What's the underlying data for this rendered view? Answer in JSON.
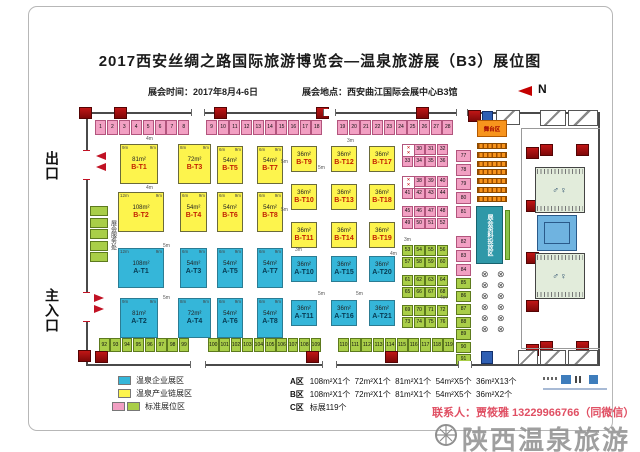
{
  "title": "2017西安丝绸之路国际旅游博览会—温泉旅游展（B3）展位图",
  "subtitle": {
    "time": "展会时间：2017年8月4-6日",
    "venue": "展会地点：西安曲江国际会展中心B3馆"
  },
  "north_label": "N",
  "labels": {
    "exit": "出口",
    "main_entrance": "主入口",
    "service_desk": "展会服务处",
    "stage": "舞台区",
    "info_strip": "展会资料投放区"
  },
  "icons": {
    "restroom": "♂♀",
    "table": "⊗",
    "no_booth": "✕\n✕"
  },
  "colors": {
    "booth_blue": "#35b6d9",
    "booth_yellow": "#fdf44d",
    "standard_pink": "#f2a0c3",
    "standard_green": "#a9ce48",
    "pillar_red": "#b01212",
    "stage_orange": "#f7941d",
    "info_teal": "#2f98a8",
    "accent_red": "#c11224",
    "contact_red": "#e04f63"
  },
  "legend": {
    "items": [
      {
        "swatches": [
          "blue"
        ],
        "label": "温泉企业展区"
      },
      {
        "swatches": [
          "yellow"
        ],
        "label": "温泉产业链展区"
      },
      {
        "swatches": [
          "pink",
          "green"
        ],
        "label": "标准展位区"
      }
    ],
    "stats": [
      {
        "zone": "A区",
        "detail": "108m²X1个  72m²X1个  81m²X1个  54m²X5个  36m²X13个"
      },
      {
        "zone": "B区",
        "detail": "108m²X1个  72m²X1个  81m²X1个  54m²X5个  36m²X2个"
      },
      {
        "zone": "C区",
        "detail": "标展119个"
      }
    ]
  },
  "contact": "联系人：贾筱雅 13229966766（同微信）",
  "watermark": "陕西温泉旅游",
  "plan": {
    "booths": [
      {
        "name": "B-T1",
        "area": "81m²",
        "x": 120,
        "y": 144,
        "w": 38,
        "h": 40,
        "wm": "9m",
        "dm": "9m"
      },
      {
        "name": "B-T3",
        "area": "72m²",
        "x": 178,
        "y": 144,
        "w": 33,
        "h": 40,
        "wm": "8m",
        "dm": "9m"
      },
      {
        "name": "B-T5",
        "area": "54m²",
        "x": 217,
        "y": 146,
        "w": 26,
        "h": 38,
        "wm": "6m",
        "dm": "9m"
      },
      {
        "name": "B-T7",
        "area": "54m²",
        "x": 257,
        "y": 146,
        "w": 26,
        "h": 38,
        "wm": "6m",
        "dm": "9m"
      },
      {
        "name": "B-T2",
        "area": "108m²",
        "x": 118,
        "y": 192,
        "w": 46,
        "h": 40,
        "wm": "12m",
        "dm": "9m"
      },
      {
        "name": "B-T4",
        "area": "54m²",
        "x": 180,
        "y": 192,
        "w": 27,
        "h": 40,
        "wm": "6m",
        "dm": "9m"
      },
      {
        "name": "B-T6",
        "area": "54m²",
        "x": 217,
        "y": 192,
        "w": 26,
        "h": 40,
        "wm": "6m",
        "dm": "9m"
      },
      {
        "name": "B-T8",
        "area": "54m²",
        "x": 257,
        "y": 192,
        "w": 26,
        "h": 40,
        "wm": "6m",
        "dm": "9m"
      },
      {
        "name": "B-T9",
        "area": "36m²",
        "x": 291,
        "y": 146,
        "w": 26,
        "h": 26
      },
      {
        "name": "B-T10",
        "area": "36m²",
        "x": 291,
        "y": 184,
        "w": 26,
        "h": 26
      },
      {
        "name": "B-T11",
        "area": "36m²",
        "x": 291,
        "y": 222,
        "w": 26,
        "h": 26
      },
      {
        "name": "B-T12",
        "area": "36m²",
        "x": 331,
        "y": 146,
        "w": 26,
        "h": 26
      },
      {
        "name": "B-T13",
        "area": "36m²",
        "x": 331,
        "y": 184,
        "w": 26,
        "h": 26
      },
      {
        "name": "B-T14",
        "area": "36m²",
        "x": 331,
        "y": 222,
        "w": 26,
        "h": 26
      },
      {
        "name": "B-T17",
        "area": "36m²",
        "x": 369,
        "y": 146,
        "w": 26,
        "h": 26
      },
      {
        "name": "B-T18",
        "area": "36m²",
        "x": 369,
        "y": 184,
        "w": 26,
        "h": 26
      },
      {
        "name": "B-T19",
        "area": "36m²",
        "x": 369,
        "y": 222,
        "w": 26,
        "h": 26
      },
      {
        "name": "A-T1",
        "area": "108m²",
        "x": 118,
        "y": 248,
        "w": 46,
        "h": 40,
        "wm": "12m",
        "dm": "9m"
      },
      {
        "name": "A-T3",
        "area": "54m²",
        "x": 180,
        "y": 248,
        "w": 27,
        "h": 40,
        "wm": "6m",
        "dm": "9m"
      },
      {
        "name": "A-T5",
        "area": "54m²",
        "x": 217,
        "y": 248,
        "w": 26,
        "h": 40,
        "wm": "6m",
        "dm": "9m"
      },
      {
        "name": "A-T7",
        "area": "54m²",
        "x": 257,
        "y": 248,
        "w": 26,
        "h": 40,
        "wm": "6m",
        "dm": "9m"
      },
      {
        "name": "A-T2",
        "area": "81m²",
        "x": 120,
        "y": 298,
        "w": 38,
        "h": 40,
        "wm": "9m",
        "dm": "9m"
      },
      {
        "name": "A-T4",
        "area": "72m²",
        "x": 178,
        "y": 298,
        "w": 33,
        "h": 40,
        "wm": "8m",
        "dm": "9m"
      },
      {
        "name": "A-T6",
        "area": "54m²",
        "x": 217,
        "y": 298,
        "w": 26,
        "h": 40,
        "wm": "6m",
        "dm": "9m"
      },
      {
        "name": "A-T8",
        "area": "54m²",
        "x": 257,
        "y": 298,
        "w": 26,
        "h": 40,
        "wm": "6m",
        "dm": "9m"
      },
      {
        "name": "A-T10",
        "area": "36m²",
        "x": 291,
        "y": 256,
        "w": 26,
        "h": 26
      },
      {
        "name": "A-T11",
        "area": "36m²",
        "x": 291,
        "y": 300,
        "w": 26,
        "h": 26
      },
      {
        "name": "A-T15",
        "area": "36m²",
        "x": 331,
        "y": 256,
        "w": 26,
        "h": 26
      },
      {
        "name": "A-T16",
        "area": "36m²",
        "x": 331,
        "y": 300,
        "w": 26,
        "h": 26
      },
      {
        "name": "A-T20",
        "area": "36m²",
        "x": 369,
        "y": 256,
        "w": 26,
        "h": 26
      },
      {
        "name": "A-T21",
        "area": "36m²",
        "x": 369,
        "y": 300,
        "w": 26,
        "h": 26
      }
    ],
    "standard_groups": [
      {
        "start": 1,
        "end": 8,
        "x": 95,
        "y": 120,
        "pitch": 11.9,
        "w": 11,
        "h": 15,
        "color": "pink",
        "dir": "h"
      },
      {
        "start": 9,
        "end": 18,
        "x": 206,
        "y": 120,
        "pitch": 11.7,
        "w": 11,
        "h": 15,
        "color": "pink",
        "dir": "h"
      },
      {
        "start": 19,
        "end": 28,
        "x": 337,
        "y": 120,
        "pitch": 11.7,
        "w": 11,
        "h": 15,
        "color": "pink",
        "dir": "h"
      },
      {
        "start": 30,
        "end": 32,
        "x": 413.7,
        "y": 144,
        "pitch": 11.7,
        "w": 11,
        "h": 11,
        "color": "pink",
        "dir": "h"
      },
      {
        "start": 33,
        "end": 36,
        "x": 402,
        "y": 155.5,
        "pitch": 11.7,
        "w": 11,
        "h": 11,
        "color": "pink",
        "dir": "h"
      },
      {
        "start": 38,
        "end": 40,
        "x": 413.7,
        "y": 176,
        "pitch": 11.7,
        "w": 11,
        "h": 11,
        "color": "pink",
        "dir": "h"
      },
      {
        "start": 41,
        "end": 44,
        "x": 402,
        "y": 187.5,
        "pitch": 11.7,
        "w": 11,
        "h": 11,
        "color": "pink",
        "dir": "h"
      },
      {
        "start": 45,
        "end": 48,
        "x": 402,
        "y": 206,
        "pitch": 11.7,
        "w": 11,
        "h": 11,
        "color": "pink",
        "dir": "h"
      },
      {
        "start": 49,
        "end": 52,
        "x": 402,
        "y": 217.5,
        "pitch": 11.7,
        "w": 11,
        "h": 11,
        "color": "pink",
        "dir": "h"
      },
      {
        "start": 53,
        "end": 56,
        "x": 402,
        "y": 245,
        "pitch": 11.7,
        "w": 11,
        "h": 11,
        "color": "green",
        "dir": "h"
      },
      {
        "start": 57,
        "end": 60,
        "x": 402,
        "y": 256.5,
        "pitch": 11.7,
        "w": 11,
        "h": 11,
        "color": "green",
        "dir": "h"
      },
      {
        "start": 61,
        "end": 64,
        "x": 402,
        "y": 275,
        "pitch": 11.7,
        "w": 11,
        "h": 11,
        "color": "green",
        "dir": "h"
      },
      {
        "start": 65,
        "end": 68,
        "x": 402,
        "y": 286.5,
        "pitch": 11.7,
        "w": 11,
        "h": 11,
        "color": "green",
        "dir": "h"
      },
      {
        "start": 69,
        "end": 72,
        "x": 402,
        "y": 305,
        "pitch": 11.7,
        "w": 11,
        "h": 11,
        "color": "green",
        "dir": "h"
      },
      {
        "start": 73,
        "end": 76,
        "x": 402,
        "y": 316.5,
        "pitch": 11.7,
        "w": 11,
        "h": 11,
        "color": "green",
        "dir": "h"
      },
      {
        "start": 77,
        "end": 81,
        "x": 456,
        "y": 150,
        "pitch": 14,
        "w": 15,
        "h": 12,
        "color": "pink",
        "dir": "v"
      },
      {
        "start": 82,
        "end": 84,
        "x": 456,
        "y": 236,
        "pitch": 14,
        "w": 15,
        "h": 12,
        "color": "pink",
        "dir": "v"
      },
      {
        "start": 85,
        "end": 86,
        "x": 456,
        "y": 278,
        "pitch": 13,
        "w": 15,
        "h": 11,
        "color": "green",
        "dir": "v"
      },
      {
        "start": 87,
        "end": 91,
        "x": 456,
        "y": 304,
        "pitch": 12.5,
        "w": 15,
        "h": 11,
        "color": "green",
        "dir": "v"
      },
      {
        "start": 92,
        "end": 99,
        "x": 99,
        "y": 338,
        "pitch": 11.4,
        "w": 10.5,
        "h": 14,
        "color": "green",
        "dir": "h"
      },
      {
        "start": 100,
        "end": 109,
        "x": 208,
        "y": 338,
        "pitch": 11.4,
        "w": 10.5,
        "h": 14,
        "color": "green",
        "dir": "h"
      },
      {
        "start": 110,
        "end": 119,
        "x": 338,
        "y": 338,
        "pitch": 11.7,
        "w": 11,
        "h": 14,
        "color": "green",
        "dir": "h"
      }
    ],
    "icon_cells": [
      [
        402,
        144
      ],
      [
        402,
        176
      ]
    ],
    "pillars": [
      [
        114,
        107
      ],
      [
        214,
        107
      ],
      [
        316,
        107
      ],
      [
        416,
        107
      ],
      [
        468,
        110
      ],
      [
        79,
        107
      ],
      [
        78,
        350
      ],
      [
        95,
        351
      ],
      [
        306,
        351
      ],
      [
        385,
        351
      ],
      [
        526,
        147
      ],
      [
        526,
        200
      ],
      [
        526,
        252
      ],
      [
        526,
        300
      ],
      [
        526,
        344
      ],
      [
        540,
        144
      ],
      [
        576,
        144
      ],
      [
        540,
        341
      ],
      [
        576,
        341
      ]
    ],
    "rooms": [
      [
        496,
        110,
        24,
        15
      ],
      [
        540,
        110,
        26,
        16
      ],
      [
        568,
        110,
        30,
        16
      ],
      [
        540,
        350,
        26,
        15
      ],
      [
        568,
        350,
        30,
        15
      ],
      [
        518,
        350,
        20,
        15
      ]
    ],
    "blue_boxes": [
      [
        482,
        111,
        11,
        13
      ],
      [
        481,
        351,
        12,
        13
      ]
    ],
    "doors": {
      "top": [
        [
          191,
          14
        ],
        [
          323,
          13
        ],
        [
          456,
          12
        ]
      ],
      "bottom": [
        [
          190,
          16
        ],
        [
          322,
          15
        ],
        [
          458,
          14
        ]
      ],
      "left": [
        [
          150,
          30
        ],
        [
          292,
          30
        ]
      ]
    },
    "stage": {
      "x": 477,
      "y": 120,
      "w": 30,
      "h": 17,
      "seat_rows": 7,
      "seat_y0": 143,
      "seat_pitch": 8.8,
      "seat_h": 6
    },
    "info_strip": {
      "x": 476,
      "y": 206,
      "w": 27,
      "h": 58
    },
    "green_strip": {
      "x": 505,
      "y": 210,
      "w": 5,
      "h": 50
    },
    "tables": {
      "cols": [
        481,
        497
      ],
      "y0": 270,
      "pitch": 11,
      "rows": 6
    },
    "restrooms": [
      [
        535,
        167,
        50,
        46
      ],
      [
        535,
        253,
        50,
        46
      ]
    ],
    "blue_room": [
      537,
      215,
      40,
      36
    ],
    "service_cells": {
      "x": 90,
      "y": 206,
      "w": 18,
      "h": 10,
      "pitch": 11.5,
      "count": 5
    },
    "aisle_labels": [
      [
        "4m",
        146,
        137
      ],
      [
        "4m",
        146,
        186
      ],
      [
        "5m",
        163,
        244
      ],
      [
        "5m",
        281,
        160
      ],
      [
        "5m",
        281,
        208
      ],
      [
        "3m",
        347,
        139
      ],
      [
        "5m",
        318,
        166
      ],
      [
        "5m",
        318,
        292
      ],
      [
        "5m",
        356,
        292
      ],
      [
        "3m",
        295,
        248
      ],
      [
        "3m",
        404,
        238
      ],
      [
        "4m",
        390,
        252
      ],
      [
        "4m",
        440,
        296
      ],
      [
        "5m",
        163,
        296
      ]
    ]
  }
}
